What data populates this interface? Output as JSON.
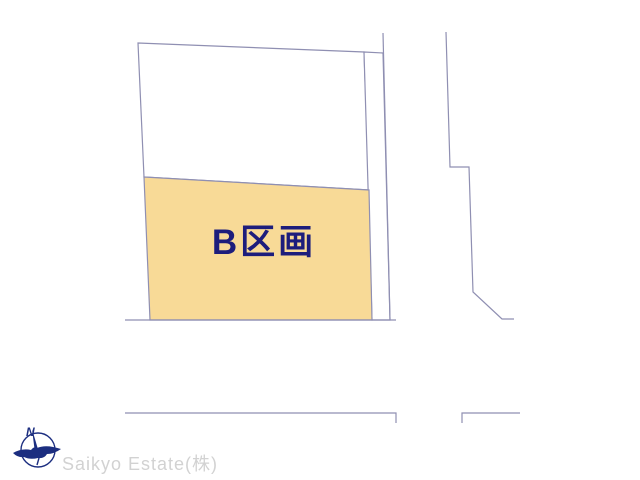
{
  "page": {
    "background_color": "#ffffff",
    "width": 640,
    "height": 480
  },
  "diagram": {
    "parcel_label": "B区画",
    "parcel_label_color": "#1d1d7c",
    "parcel_fill_color": "#f8da97",
    "outline_color": "#8f8fb2",
    "shapes": [
      {
        "name": "upper-parcel",
        "type": "polygon",
        "fill": "#ffffff",
        "points": [
          [
            138,
            43
          ],
          [
            364,
            52
          ],
          [
            369,
            190
          ],
          [
            144,
            177
          ]
        ]
      },
      {
        "name": "side-strip",
        "type": "polygon",
        "fill": "#ffffff",
        "points": [
          [
            364,
            52
          ],
          [
            383,
            53
          ],
          [
            390,
            320
          ],
          [
            372,
            320
          ]
        ]
      },
      {
        "name": "parcel-b",
        "type": "polygon",
        "fill": "#f8da97",
        "points": [
          [
            144,
            177
          ],
          [
            369,
            190
          ],
          [
            372,
            320
          ],
          [
            150,
            320
          ]
        ]
      },
      {
        "name": "road-edge-right",
        "type": "polyline",
        "points": [
          [
            383,
            33
          ],
          [
            390,
            320
          ]
        ]
      },
      {
        "name": "road-edge-bottom",
        "type": "polyline",
        "points": [
          [
            125,
            320
          ],
          [
            396,
            320
          ]
        ]
      },
      {
        "name": "road-edge-far-right",
        "type": "polyline",
        "points": [
          [
            446,
            32
          ],
          [
            450,
            167
          ],
          [
            469,
            167
          ],
          [
            473,
            292
          ],
          [
            502,
            319
          ],
          [
            514,
            319
          ]
        ]
      },
      {
        "name": "road-edge-lower-left",
        "type": "polyline",
        "points": [
          [
            125,
            413
          ],
          [
            396,
            413
          ],
          [
            396,
            423
          ]
        ]
      },
      {
        "name": "road-edge-lower-right",
        "type": "polyline",
        "points": [
          [
            462,
            423
          ],
          [
            462,
            413
          ],
          [
            520,
            413
          ]
        ]
      }
    ]
  },
  "branding": {
    "company_name": "Saikyo Estate(株)",
    "company_text_color": "#d2d2d2",
    "logo_color": "#1c2e80",
    "compass_north_label": "N"
  }
}
